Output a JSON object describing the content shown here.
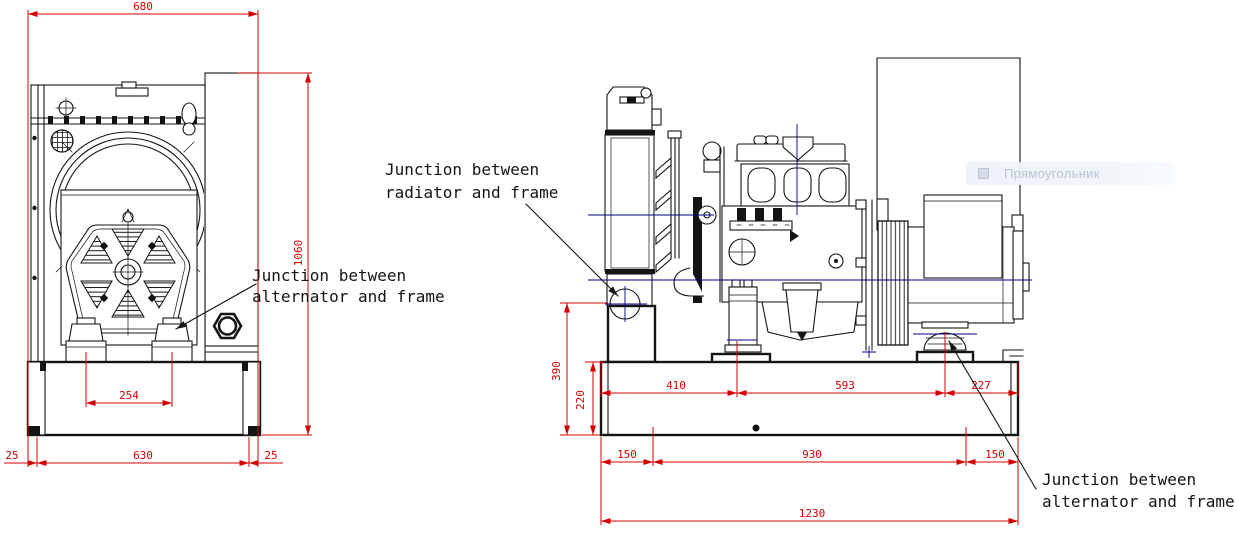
{
  "front_view": {
    "dim_width": "680",
    "dim_height": "1060",
    "dim_foot_spacing": "254",
    "dim_base_left": "25",
    "dim_base": "630",
    "dim_base_right": "25"
  },
  "side_view": {
    "dim_junction_height": "390",
    "dim_frame_height": "220",
    "dim_engine_mount": "410",
    "dim_mount_spacing": "593",
    "dim_alt_to_end": "227",
    "dim_hole_left": "150",
    "dim_hole_spacing": "930",
    "dim_hole_right": "150",
    "dim_total_length": "1230"
  },
  "annotations": {
    "radiator_frame": {
      "line1": "Junction between",
      "line2": "radiator and frame"
    },
    "alternator_frame_front": {
      "line1": "Junction between",
      "line2": "alternator and frame"
    },
    "alternator_frame_side": {
      "line1": "Junction between",
      "line2": "alternator and frame"
    }
  },
  "overlay_tooltip": {
    "label": "Прямоугольник"
  },
  "colors": {
    "dimension_red": "#d40000",
    "drawing_black": "#141414",
    "centerline_blue": "#00007f",
    "tooltip_bg": "#edf2f9",
    "tooltip_text": "#b7c4d6"
  }
}
